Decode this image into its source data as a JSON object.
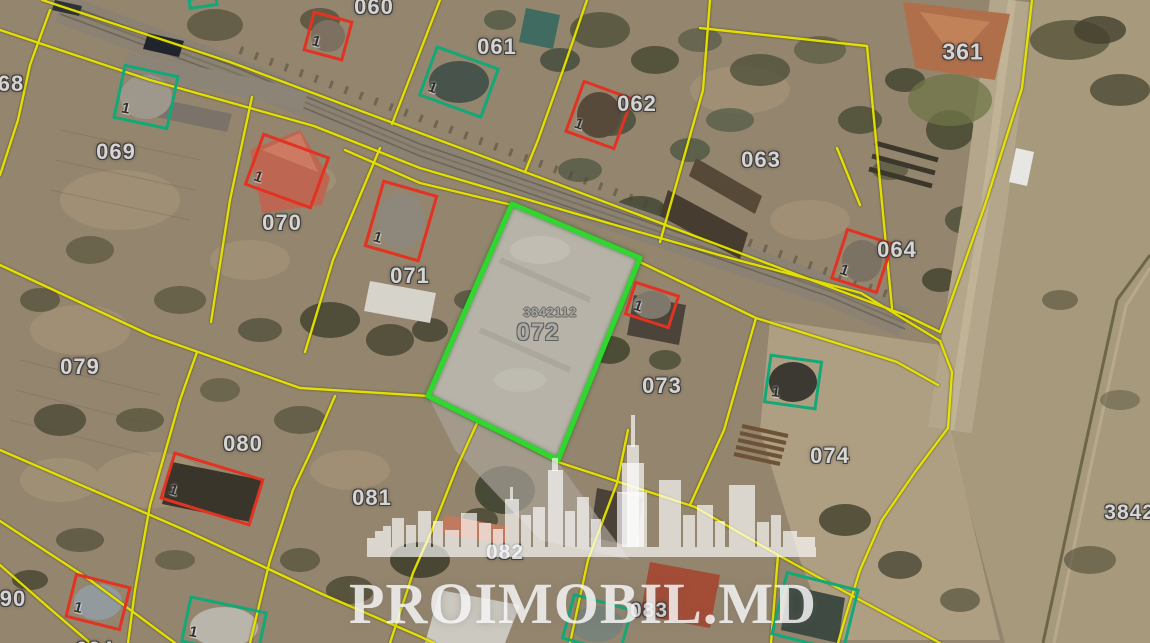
{
  "map": {
    "watermark": {
      "brand": "PROIMOBIL.MD",
      "logo": "city-skyline"
    },
    "highlighted_parcel": {
      "cadastral_code": "3842112",
      "number": "072",
      "outline": "green"
    },
    "colors": {
      "parcel_boundary": "#e8e400",
      "highlight_outline": "#2fd82f",
      "building_outline_red": "#e23222",
      "building_outline_green": "#12a878",
      "label_text": "#d9d9d9"
    },
    "parcel_labels": [
      {
        "text": "68",
        "x": 11,
        "y": 84,
        "variant": "std",
        "size": 22
      },
      {
        "text": "060",
        "x": 374,
        "y": 7,
        "variant": "std",
        "size": 22
      },
      {
        "text": "061",
        "x": 497,
        "y": 47,
        "variant": "std",
        "size": 22
      },
      {
        "text": "062",
        "x": 637,
        "y": 104,
        "variant": "std",
        "size": 22
      },
      {
        "text": "063",
        "x": 761,
        "y": 160,
        "variant": "std",
        "size": 22
      },
      {
        "text": "361",
        "x": 963,
        "y": 52,
        "variant": "std",
        "size": 23
      },
      {
        "text": "064",
        "x": 897,
        "y": 250,
        "variant": "std",
        "size": 22
      },
      {
        "text": "069",
        "x": 116,
        "y": 152,
        "variant": "std",
        "size": 22
      },
      {
        "text": "070",
        "x": 282,
        "y": 223,
        "variant": "std",
        "size": 22
      },
      {
        "text": "071",
        "x": 410,
        "y": 276,
        "variant": "std",
        "size": 22
      },
      {
        "text": "3842112",
        "x": 550,
        "y": 312,
        "variant": "code",
        "size": 13
      },
      {
        "text": "072",
        "x": 538,
        "y": 333,
        "variant": "gray",
        "size": 24
      },
      {
        "text": "073",
        "x": 662,
        "y": 386,
        "variant": "std",
        "size": 22
      },
      {
        "text": "074",
        "x": 830,
        "y": 456,
        "variant": "std",
        "size": 22
      },
      {
        "text": "079",
        "x": 80,
        "y": 367,
        "variant": "std",
        "size": 22
      },
      {
        "text": "080",
        "x": 243,
        "y": 444,
        "variant": "std",
        "size": 22
      },
      {
        "text": "081",
        "x": 372,
        "y": 498,
        "variant": "std",
        "size": 22
      },
      {
        "text": "082",
        "x": 505,
        "y": 553,
        "variant": "std",
        "size": 21
      },
      {
        "text": "083",
        "x": 649,
        "y": 611,
        "variant": "std",
        "size": 21
      },
      {
        "text": "90",
        "x": 13,
        "y": 599,
        "variant": "std",
        "size": 22
      },
      {
        "text": "094",
        "x": 95,
        "y": 650,
        "variant": "std",
        "size": 21
      },
      {
        "text": "38421",
        "x": 1136,
        "y": 513,
        "variant": "std",
        "size": 21
      }
    ],
    "building_markers": [
      {
        "color": "green",
        "label": "1",
        "x": 146,
        "y": 97,
        "w": 57,
        "h": 56,
        "rot": 12
      },
      {
        "color": "green",
        "label": "1",
        "x": 459,
        "y": 82,
        "w": 68,
        "h": 54,
        "rot": 20
      },
      {
        "color": "green",
        "label": "1",
        "x": 793,
        "y": 382,
        "w": 54,
        "h": 50,
        "rot": 8
      },
      {
        "color": "green",
        "label": "1",
        "x": 224,
        "y": 627,
        "w": 80,
        "h": 48,
        "rot": 12
      },
      {
        "color": "green",
        "label": "",
        "x": 597,
        "y": 624,
        "w": 62,
        "h": 48,
        "rot": 15
      },
      {
        "color": "green",
        "label": "",
        "x": 815,
        "y": 612,
        "w": 76,
        "h": 66,
        "rot": 14
      },
      {
        "color": "green",
        "label": "",
        "x": 203,
        "y": 2,
        "w": 30,
        "h": 12,
        "rot": -8
      },
      {
        "color": "red",
        "label": "1",
        "x": 328,
        "y": 36,
        "w": 42,
        "h": 42,
        "rot": 15
      },
      {
        "color": "red",
        "label": "1",
        "x": 287,
        "y": 171,
        "w": 72,
        "h": 56,
        "rot": 20
      },
      {
        "color": "red",
        "label": "1",
        "x": 401,
        "y": 221,
        "w": 58,
        "h": 70,
        "rot": 16
      },
      {
        "color": "red",
        "label": "1",
        "x": 599,
        "y": 115,
        "w": 54,
        "h": 56,
        "rot": 20
      },
      {
        "color": "red",
        "label": "1",
        "x": 862,
        "y": 261,
        "w": 50,
        "h": 54,
        "rot": 18
      },
      {
        "color": "red",
        "label": "1",
        "x": 652,
        "y": 305,
        "w": 48,
        "h": 36,
        "rot": 18
      },
      {
        "color": "red",
        "label": "1",
        "x": 212,
        "y": 489,
        "w": 95,
        "h": 50,
        "rot": 17
      },
      {
        "color": "red",
        "label": "1",
        "x": 98,
        "y": 602,
        "w": 58,
        "h": 46,
        "rot": 14
      }
    ]
  }
}
